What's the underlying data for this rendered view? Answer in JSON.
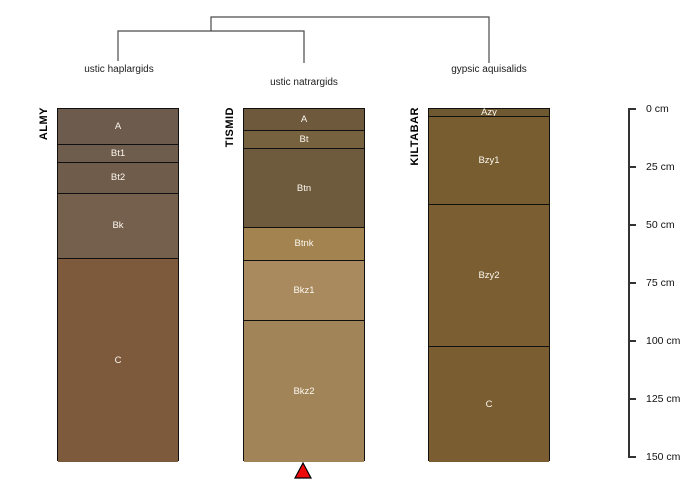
{
  "chart_data": {
    "type": "bar",
    "subtype": "soil-profile-collection-with-dendrogram",
    "title": "",
    "depth_unit": "cm",
    "ylim": [
      0,
      152
    ],
    "depth_axis": {
      "ticks": [
        0,
        25,
        50,
        75,
        100,
        125,
        150
      ],
      "labels": [
        "0 cm",
        "25 cm",
        "50 cm",
        "75 cm",
        "100 cm",
        "125 cm",
        "150 cm"
      ]
    },
    "dendrogram": {
      "structure": "((ALMY,TISMID),KILTABAR)",
      "line_color": "#4a4a4a",
      "groups": [
        {
          "label": "ustic haplargids",
          "profile": "ALMY"
        },
        {
          "label": "ustic natrargids",
          "profile": "TISMID"
        },
        {
          "label": "gypsic aquisalids",
          "profile": "KILTABAR"
        }
      ]
    },
    "profiles": [
      {
        "id": "ALMY",
        "taxon": "ustic haplargids",
        "horizons": [
          {
            "name": "A",
            "top": 0,
            "bottom": 15,
            "color": "#6d5b4d"
          },
          {
            "name": "Bt1",
            "top": 15,
            "bottom": 23,
            "color": "#6e5c4c"
          },
          {
            "name": "Bt2",
            "top": 23,
            "bottom": 36,
            "color": "#6f5c4b"
          },
          {
            "name": "Bk",
            "top": 36,
            "bottom": 64,
            "color": "#755f4d"
          },
          {
            "name": "C",
            "top": 64,
            "bottom": 152,
            "color": "#7e5a3d"
          }
        ]
      },
      {
        "id": "TISMID",
        "taxon": "ustic natrargids",
        "marker": {
          "shape": "triangle-up",
          "color": "#ee0a0a"
        },
        "horizons": [
          {
            "name": "A",
            "top": 0,
            "bottom": 9,
            "color": "#6e593c"
          },
          {
            "name": "Bt",
            "top": 9,
            "bottom": 17,
            "color": "#77623f"
          },
          {
            "name": "Btn",
            "top": 17,
            "bottom": 51,
            "color": "#6e5b3e"
          },
          {
            "name": "Btnk",
            "top": 51,
            "bottom": 65,
            "color": "#a3834f"
          },
          {
            "name": "Bkz1",
            "top": 65,
            "bottom": 91,
            "color": "#a98a5e"
          },
          {
            "name": "Bkz2",
            "top": 91,
            "bottom": 152,
            "color": "#a28459"
          }
        ]
      },
      {
        "id": "KILTABAR",
        "taxon": "gypsic aquisalids",
        "horizons": [
          {
            "name": "Azy",
            "top": 0,
            "bottom": 3,
            "color": "#6f5930"
          },
          {
            "name": "Bzy1",
            "top": 3,
            "bottom": 41,
            "color": "#785d31"
          },
          {
            "name": "Bzy2",
            "top": 41,
            "bottom": 102,
            "color": "#7b5f33"
          },
          {
            "name": "C",
            "top": 102,
            "bottom": 152,
            "color": "#7a5e32"
          }
        ]
      }
    ]
  }
}
